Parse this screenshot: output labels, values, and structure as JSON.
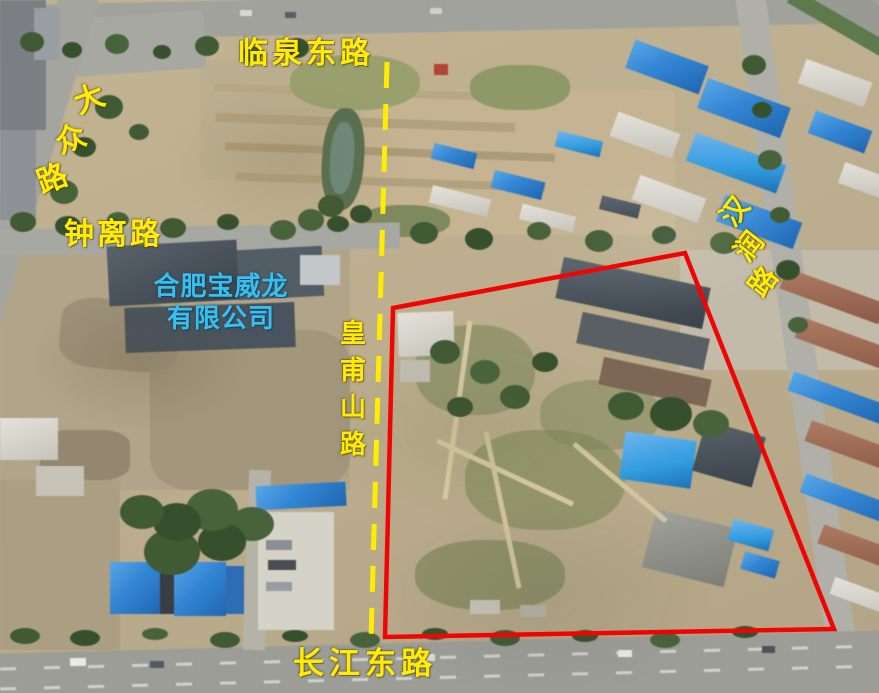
{
  "labels": {
    "linquan_east_road": "临泉东路",
    "dazhong_road": "大众路",
    "zhongli_road": "钟离路",
    "huangfushan_road": "皇甫山路",
    "hanrun_road": "汉润路",
    "changjiang_east_road": "长江东路",
    "company_line1": "合肥宝威龙",
    "company_line2": "有限公司"
  },
  "colors": {
    "road_label_text": "#ffec00",
    "company_label_text": "#38bfee",
    "parcel_outline": "#f10404",
    "planned_road_line": "#ffec00"
  },
  "overlay": {
    "parcel_outline_points": "393,308 685,253 834,629 385,637",
    "parcel_outline_width": "4.5",
    "planned_road_line": {
      "x1": "387",
      "y1": "62",
      "x2": "371",
      "y2": "640",
      "dash": "26 16",
      "width": "5"
    }
  }
}
